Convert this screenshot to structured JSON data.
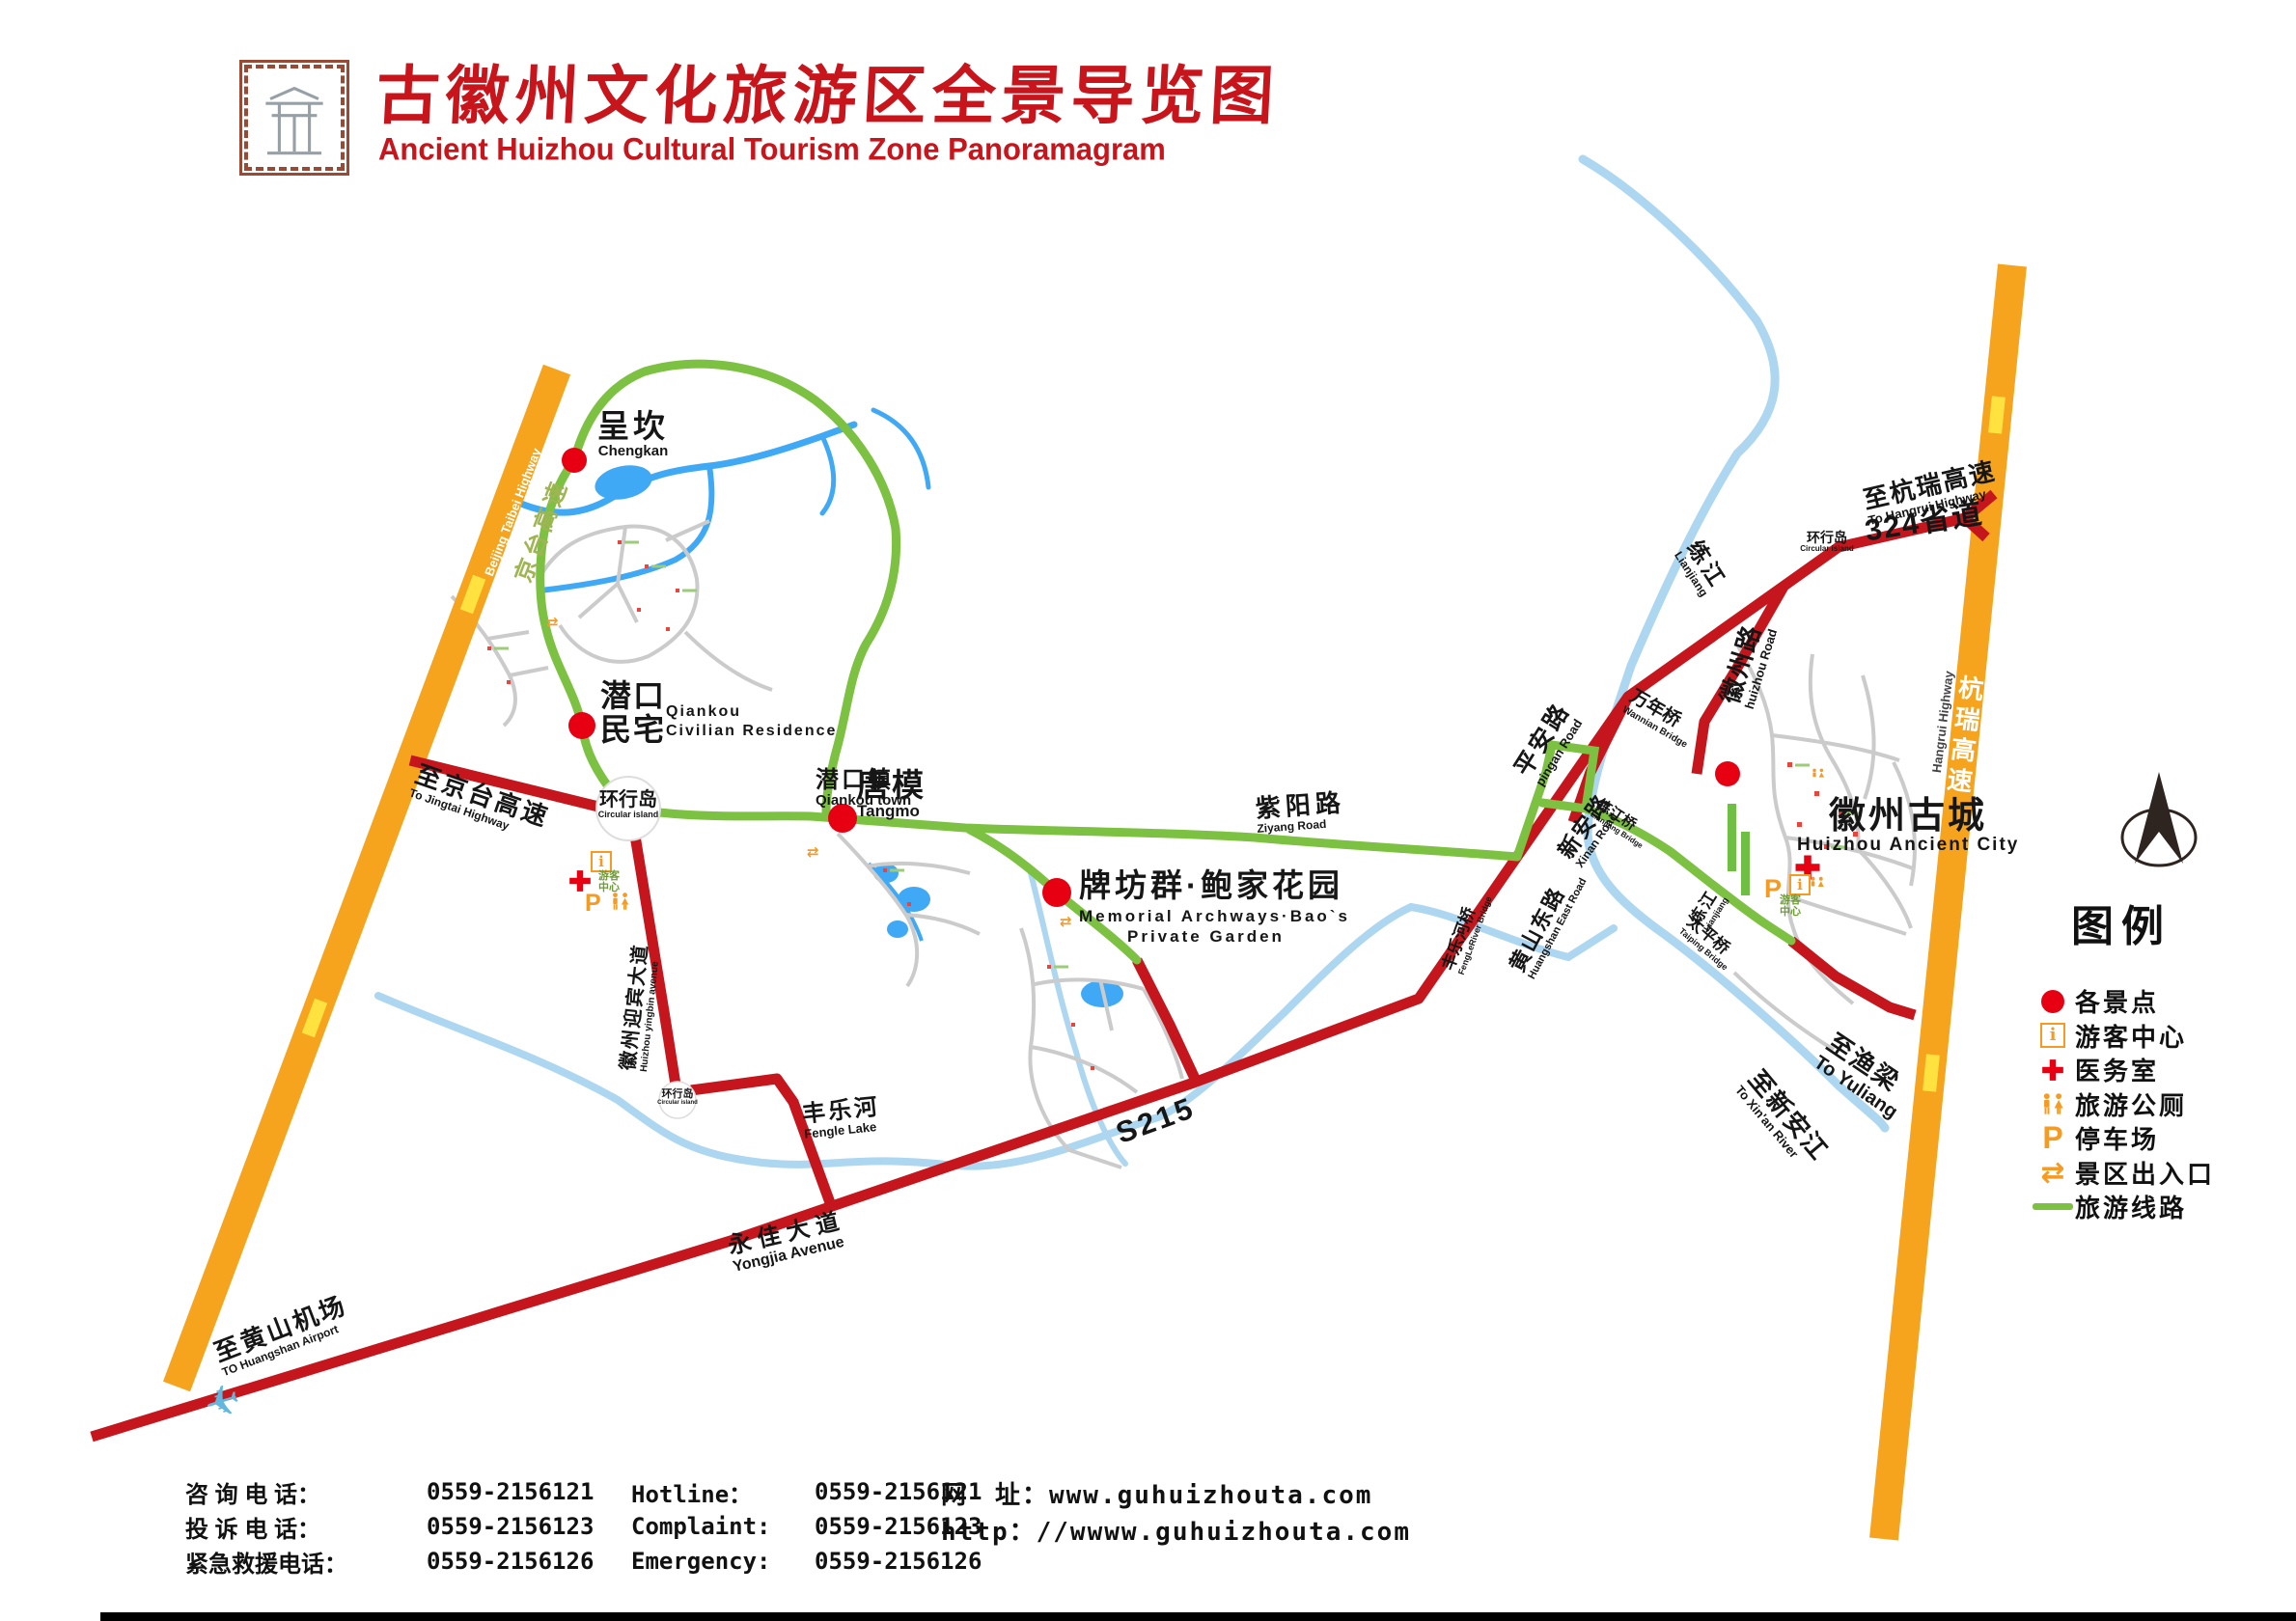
{
  "colors": {
    "title_red": "#c8141b",
    "highway_orange": "#f6a41e",
    "road_red": "#c5161d",
    "route_green": "#7cc141",
    "river_blue": "#add6f0",
    "stream_blue": "#3fa9f5",
    "spot_red": "#e60012",
    "icon_orange": "#f59a23"
  },
  "header": {
    "title_cn": "古徽州文化旅游区全景导览图",
    "title_en": "Ancient Huizhou Cultural Tourism Zone Panoramagram",
    "logo": "huizhou-gate-emblem"
  },
  "icons": {
    "info_glyph": "i",
    "parking_glyph": "P",
    "entrance_glyph": "⇄"
  },
  "map": {
    "labels": {
      "chengkan_cn": "呈坎",
      "chengkan_en": "Chengkan",
      "qiankou_cn1": "潜口",
      "qiankou_cn2": "民宅",
      "qiankou_en1": "Qiankou",
      "qiankou_en2": "Civilian Residence",
      "qiankou_town_cn": "潜口镇",
      "qiankou_town_en": "Qiankou town",
      "circular_island_cn": "环行岛",
      "circular_island_en": "Circular island",
      "tangmo_cn": "唐模",
      "tangmo_en": "Tangmo",
      "paifang_cn": "牌坊群·鲍家花园",
      "paifang_en1": "Memorial Archways·Bao`s",
      "paifang_en2": "Private Garden",
      "ziyang_cn": "紫阳路",
      "ziyang_en": "Ziyang Road",
      "pingan_cn": "平安路",
      "pingan_en": "pingan Road",
      "xinan_cn": "新安路",
      "xinan_en": "Xinan Road",
      "huangshan_east_cn": "黄山东路",
      "huangshan_east_en": "Huangshan East Road",
      "lianjiang_bridge_cn": "练江桥",
      "lianjiang_bridge_en": "Lianjiang Bridge",
      "fengle_bridge_cn": "丰乐河桥",
      "fengle_bridge_en": "FengLeRiver Bridge",
      "lianjiang_cn": "练江",
      "lianjiang_en": "Lianjiang",
      "wannian_cn": "万年桥",
      "wannian_en": "Wannian Bridge",
      "huizhou_road_cn": "徽州路",
      "huizhou_road_en": "huizhou Road",
      "to_hangrui_cn": "至杭瑞高速",
      "to_hangrui_en": "To Hangrui Highway",
      "s324": "324省道",
      "hangrui_cn": "杭瑞高速",
      "hangrui_en": "Hangrui Highway",
      "huizhou_city_cn": "徽州古城",
      "huizhou_city_en": "Huizhou Ancient City",
      "taiping_cn": "太平桥",
      "taiping_en": "Taiping Bridge",
      "to_yuliang_cn": "至渔梁",
      "to_yuliang_en": "To Yuliang",
      "to_xinanjiang_cn": "至新安江",
      "to_xinanjiang_en": "To Xin'an River",
      "to_jingtai_cn": "至京台高速",
      "to_jingtai_en": "To Jingtai Highway",
      "jingtai_cn": "京台高速",
      "jingtai_en": "Beijing Taibei Highway",
      "yingbin_cn": "徽州迎宾大道",
      "yingbin_en": "Huizhou yingbin avenue",
      "fengle_cn": "丰乐河",
      "fengle_en": "Fengle Lake",
      "s215": "S215",
      "yongjia_cn": "永佳大道",
      "yongjia_en": "Yongjia Avenue",
      "to_airport_cn": "至黄山机场",
      "to_airport_en": "TO Huangshan Airport",
      "tourist_center_cn": "游客中心"
    }
  },
  "legend": {
    "title": "图例",
    "items": [
      {
        "icon": "scenic-spot-dot",
        "label": "各景点"
      },
      {
        "icon": "visitor-center",
        "label": "游客中心"
      },
      {
        "icon": "clinic-cross",
        "label": "医务室"
      },
      {
        "icon": "tourist-toilet",
        "label": "旅游公厕"
      },
      {
        "icon": "parking",
        "label": "停车场"
      },
      {
        "icon": "entrance-exit",
        "label": "景区出入口"
      },
      {
        "icon": "tourism-route-line",
        "label": "旅游线路"
      }
    ]
  },
  "footer": {
    "rows": [
      {
        "label_cn": "咨 询 电 话：",
        "num1": "0559-2156121",
        "label_en": "Hotline：",
        "num2": "0559-2156121"
      },
      {
        "label_cn": "投 诉 电 话：",
        "num1": "0559-2156123",
        "label_en": "Complaint:",
        "num2": "0559-2156123"
      },
      {
        "label_cn": "紧急救援电话：",
        "num1": "0559-2156126",
        "label_en": "Emergency:",
        "num2": "0559-2156126"
      }
    ],
    "website_line1": "网　址：www.guhuizhouta.com",
    "website_line2": "http：//wwww.guhuizhouta.com"
  }
}
